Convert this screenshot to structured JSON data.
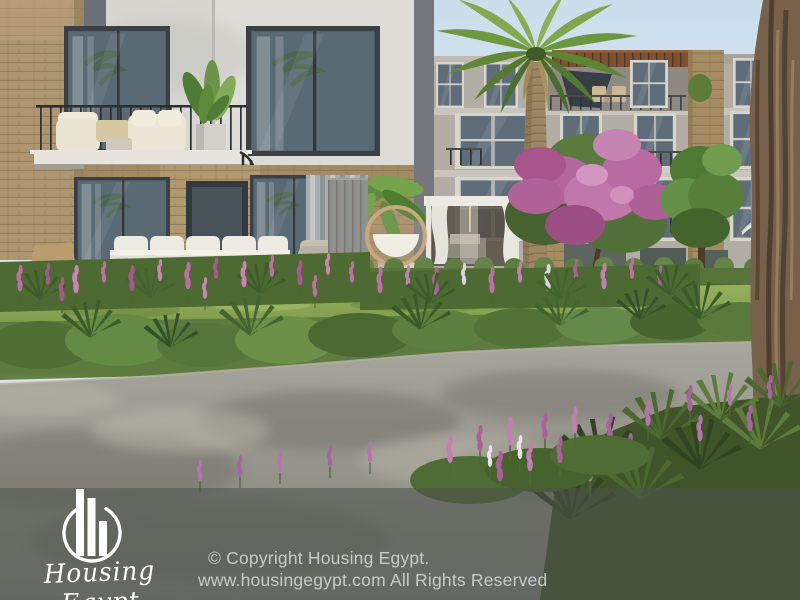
{
  "watermark": {
    "logo_icon": "buildings-in-circle-logo-icon",
    "logo_text": "Housing Egypt",
    "copyright_line1": "© Copyright Housing Egypt.",
    "copyright_line2": "www.housingegypt.com All Rights Reserved"
  },
  "palette": {
    "sky": "#cadeeb",
    "villa_white_wall": "#d7d6d1",
    "apartment_facade": "#b3aea5",
    "stone": "#ad9670",
    "window_glass": "#5e6d79",
    "window_frame_dark": "#3a4045",
    "pergola_wood": "#7c5234",
    "foliage_green": "#6d9640",
    "flower_pink": "#b4679c",
    "hedge_green": "#567439",
    "road_gray": "#98978e",
    "tree_trunk_brown": "#77614a",
    "overlay_tint": "rgba(78,82,78,0.55)",
    "watermark_text": "#d8dad5",
    "logo_white": "#ffffff"
  }
}
